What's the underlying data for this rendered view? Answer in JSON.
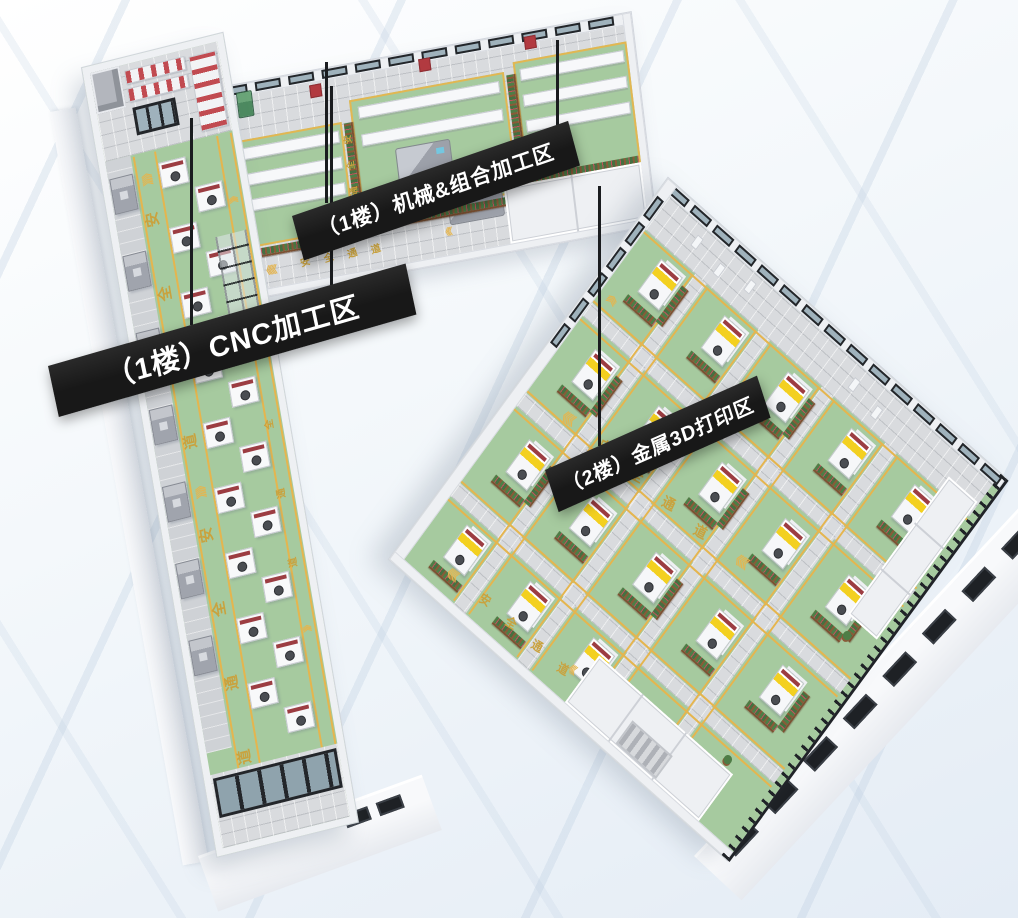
{
  "zones": [
    {
      "id": "cnc-machining",
      "banner": "（1楼）CNC加工区"
    },
    {
      "id": "mechanical-combined-machining",
      "banner": "（1楼）机械&组合加工区"
    },
    {
      "id": "metal-3d-printing",
      "banner": "（2楼）金属3D打印区"
    }
  ],
  "floor_markings": {
    "safety_lane_text": "安全通道",
    "chevron": "《"
  },
  "icons": {
    "lane_direction": "chevron-triple-left-icon"
  },
  "colors": {
    "background_top": "#ffffff",
    "background_bottom": "#e4ecf5",
    "wall_white": "#eef0f3",
    "wall_shadow": "#d2d6dd",
    "floor_green": "#a6ca9f",
    "tile_gray": "#d9dbde",
    "lane_yellow": "#e5b54e",
    "lane_text_yellow": "#c9a23e",
    "banner_black": "#181818",
    "banner_text_white": "#ffffff",
    "machine_red": "#9c3d42",
    "machine_gray": "#a0a4ad",
    "printer_yellow": "#f3d020",
    "printer_panel_dark": "#2b2e33",
    "planter_brown": "#8a5a38",
    "plant_green": "#4e7d46",
    "flower_red": "#c4515c",
    "robot_blue": "#5f7fd9",
    "robot_green": "#4d8a60",
    "frame_black": "#23262a",
    "glass_blue": "#9fb2bc"
  }
}
